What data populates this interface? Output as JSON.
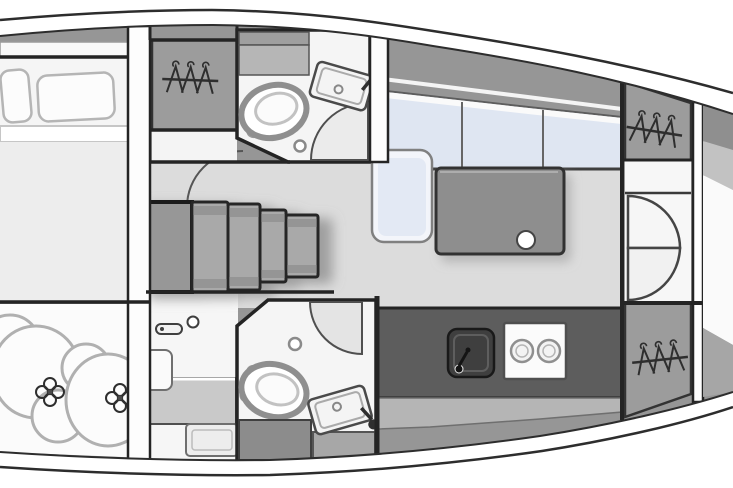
{
  "meta": {
    "title": "sailboat-interior-floor-plan",
    "view": "top-down",
    "orientation": "bow-right-cropped",
    "canvas": {
      "width": 733,
      "height": 488
    }
  },
  "colors": {
    "hull_outline": "#2d2d2d",
    "wall": "#242424",
    "deck": "#969696",
    "deck_light": "#c2c2c2",
    "floor_salon": "#dcdcdc",
    "floor_room": "#f5f5f5",
    "floor_white": "#fbfbfb",
    "mattress": "#ededed",
    "cushion": "#dfe6f2",
    "cushion_trim": "#f3f5fa",
    "locker": "#9c9c9c",
    "table": "#8e8e8e",
    "counter": "#5d5d5d",
    "sink_basin": "#3f3f3f",
    "steps": "#a9a9a9",
    "landing": "#979797",
    "cabinet_dark": "#8c8c8c",
    "cabinet_mid": "#a7a7a7",
    "vanity": "#c9c9c9",
    "under_counter": "#b5b5b5",
    "icon_stroke": "#2e2e2e"
  },
  "counts": {
    "pillows": 2,
    "hanging_lockers": 3,
    "bathrooms": 2,
    "toilets": 2,
    "bathroom_sinks": 2,
    "companionway_steps": 4,
    "settee_cushion_sections": 3,
    "stove_burners": 2,
    "cabin_door_leaves": 2,
    "fender_bundles": 2
  },
  "elements": [
    {
      "name": "hull-outline",
      "kind": "structure"
    },
    {
      "name": "side-deck-band",
      "kind": "structure"
    },
    {
      "name": "aft-cabin-bed",
      "kind": "furniture"
    },
    {
      "name": "pillow",
      "kind": "furniture"
    },
    {
      "name": "sail-locker-fenders",
      "kind": "storage",
      "icon": "lacing-cross-icon"
    },
    {
      "name": "hanging-locker",
      "kind": "storage",
      "icon": "hanger-icon"
    },
    {
      "name": "bathroom-forward",
      "kind": "room"
    },
    {
      "name": "bathroom-aft",
      "kind": "room"
    },
    {
      "name": "toilet",
      "kind": "fixture"
    },
    {
      "name": "vanity-sink",
      "kind": "fixture",
      "icon": "faucet-icon"
    },
    {
      "name": "door-swing-arc",
      "kind": "structure"
    },
    {
      "name": "companionway-steps",
      "kind": "structure"
    },
    {
      "name": "salon-settee",
      "kind": "furniture"
    },
    {
      "name": "salon-table",
      "kind": "furniture",
      "icon": "cup-holder-icon"
    },
    {
      "name": "galley-counter",
      "kind": "furniture"
    },
    {
      "name": "galley-sink",
      "kind": "fixture",
      "icon": "faucet-icon"
    },
    {
      "name": "stove-two-burners",
      "kind": "fixture",
      "icon": "burner-icon"
    },
    {
      "name": "double-cabin-doors",
      "kind": "structure"
    },
    {
      "name": "door-handle",
      "kind": "fixture",
      "icon": "handle-icon"
    }
  ]
}
